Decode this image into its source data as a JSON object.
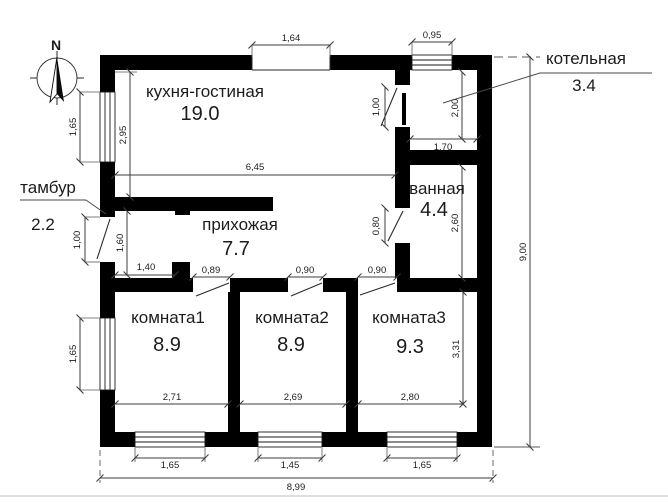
{
  "plan": {
    "type": "floor-plan",
    "units_note": "meters"
  },
  "compass": {
    "north": "N"
  },
  "rooms": {
    "kitchen": {
      "label": "кухня-гостиная",
      "area": "19.0"
    },
    "boiler": {
      "label": "котельная",
      "area": "3.4"
    },
    "bath": {
      "label": "ванная",
      "area": "4.4"
    },
    "vestibule": {
      "label": "тамбур",
      "area": "2.2"
    },
    "hall": {
      "label": "прихожая",
      "area": "7.7"
    },
    "room1": {
      "label": "комната1",
      "area": "8.9"
    },
    "room2": {
      "label": "комната2",
      "area": "8.9"
    },
    "room3": {
      "label": "комната3",
      "area": "9.3"
    }
  },
  "dims": {
    "top_opening": "1,64",
    "boiler_window": "0,95",
    "kitchen_width": "6,45",
    "kitchen_depth": "2,95",
    "left_window_top": "1,65",
    "entry_door": "1,00",
    "left_window_bottom": "1,65",
    "vestibule_depth": "1,60",
    "vestibule_width": "1,40",
    "boiler_door": "1,00",
    "boiler_depth": "2,00",
    "boiler_width": "1,70",
    "bath_door": "0,80",
    "bath_depth": "2,60",
    "hall_door1": "0,89",
    "hall_door2": "0,90",
    "hall_door3": "0,90",
    "room1_width": "2,71",
    "room2_width": "2,69",
    "room3_width": "2,80",
    "room3_depth": "3,31",
    "bottom_window1": "1,65",
    "bottom_window2": "1,45",
    "bottom_window3": "1,65",
    "overall_width": "8,99",
    "overall_height": "9,00"
  },
  "colors": {
    "wall": "#000000",
    "line": "#3c3c3c",
    "text": "#1c1c1c",
    "background": "#ffffff"
  }
}
